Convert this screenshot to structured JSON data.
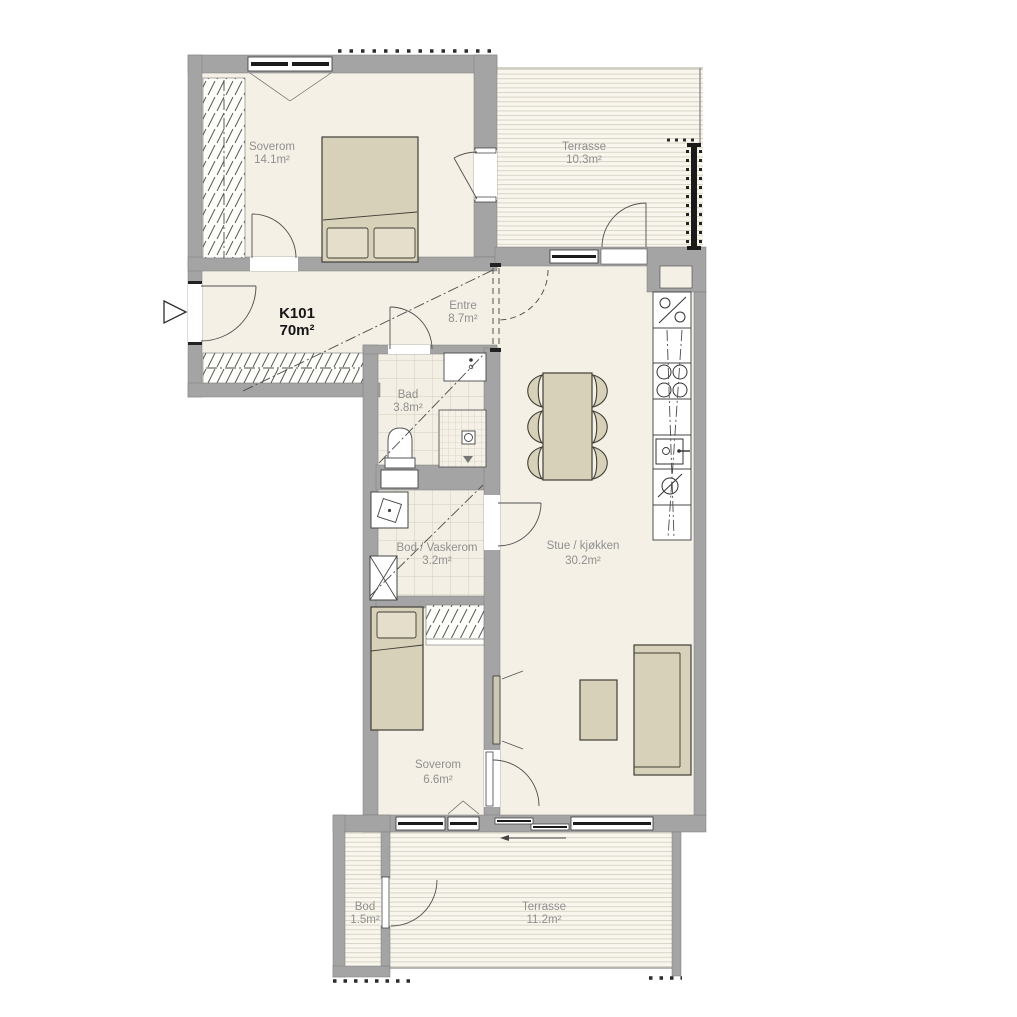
{
  "unit": {
    "id": "K101",
    "area": "70m²"
  },
  "rooms": [
    {
      "name": "Soverom",
      "area": "14.1m²"
    },
    {
      "name": "Terrasse",
      "area": "10.3m²"
    },
    {
      "name": "Entre",
      "area": "8.7m²"
    },
    {
      "name": "Bad",
      "area": "3.8m²"
    },
    {
      "name": "Stue / kjøkken",
      "area": "30.2m²"
    },
    {
      "name": "Bod / Vaskerom",
      "area": "3.2m²"
    },
    {
      "name": "Soverom",
      "area": "6.6m²"
    },
    {
      "name": "Bod",
      "area": "1.5m²"
    },
    {
      "name": "Terrasse",
      "area": "11.2m²"
    }
  ],
  "colors": {
    "wall": "#a4a4a4",
    "floor": "#f4f0e6",
    "decking_stripe": "#d9d4c5",
    "tile_line": "#d2ccbc",
    "furniture": "#d8d1ba",
    "label_text": "#8f8f8f",
    "unit_text": "#161616",
    "railing": "#1a1a1a"
  },
  "fixtures": [
    "double-bed",
    "single-bed",
    "wardrobe",
    "dining-table",
    "dining-chair",
    "sofa",
    "coffee-table",
    "tv",
    "kitchen-counter",
    "cooktop",
    "kitchen-sink",
    "fridge-symbol",
    "oven-symbol",
    "bathroom-sink",
    "toilet",
    "shower",
    "washing-machine",
    "water-heater",
    "entry-arrow",
    "glass-railing"
  ]
}
